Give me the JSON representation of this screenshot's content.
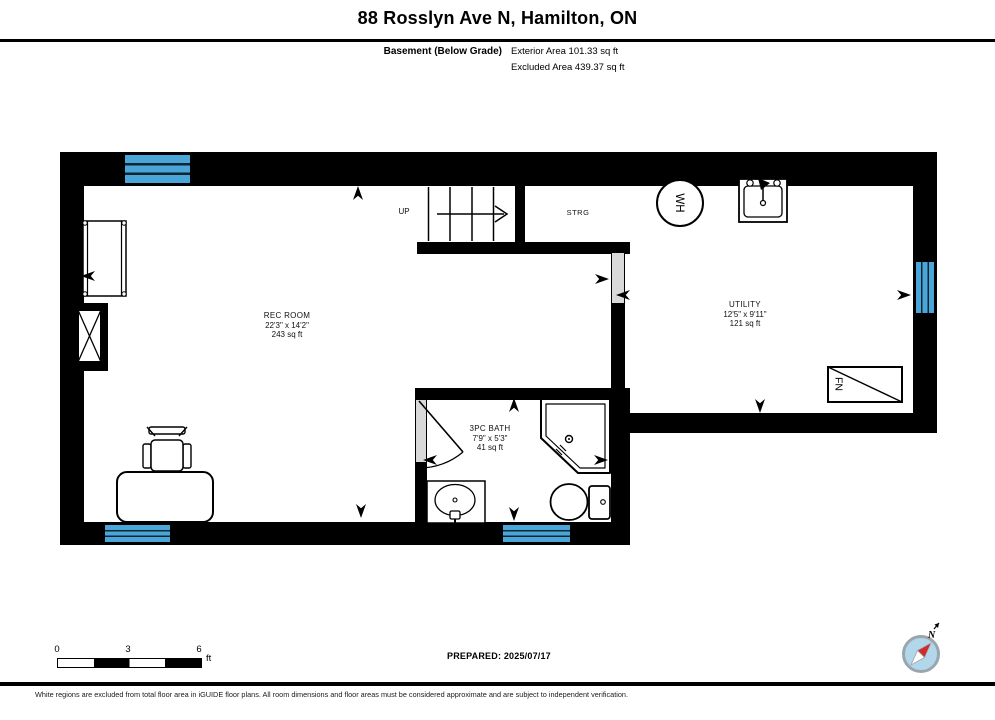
{
  "header": {
    "title": "88 Rosslyn Ave N, Hamilton, ON",
    "floor_label": "Basement (Below Grade)",
    "exterior_area": "Exterior Area 101.33 sq ft",
    "excluded_area": "Excluded Area 439.37 sq ft"
  },
  "rooms": [
    {
      "name": "REC ROOM",
      "dimensions": "22'3\" x 14'2\"",
      "area": "243 sq ft"
    },
    {
      "name": "3PC BATH",
      "dimensions": "7'9\" x 5'3\"",
      "area": "41 sq ft"
    },
    {
      "name": "UTILITY",
      "dimensions": "12'5\" x 9'11\"",
      "area": "121 sq ft"
    }
  ],
  "labels": {
    "stairs_up": "UP",
    "storage": "STRG",
    "water_heater": "WH",
    "furnace": "FN",
    "north": "N"
  },
  "scale_bar": {
    "ticks": [
      "0",
      "3",
      "6"
    ],
    "unit": "ft"
  },
  "footer": {
    "prepared": "PREPARED: 2025/07/17",
    "disclaimer": "White regions are excluded from total floor area in iGUIDE floor plans. All room dimensions and floor areas must be considered approximate and are subject to independent verification."
  },
  "colors": {
    "wall": "#000000",
    "window": "#4aa6d8",
    "window_mullion": "#0d2531",
    "door_opening": "#d9d9d9",
    "compass_fill": "#b3d7ea",
    "compass_needle": "#d22b2b"
  }
}
